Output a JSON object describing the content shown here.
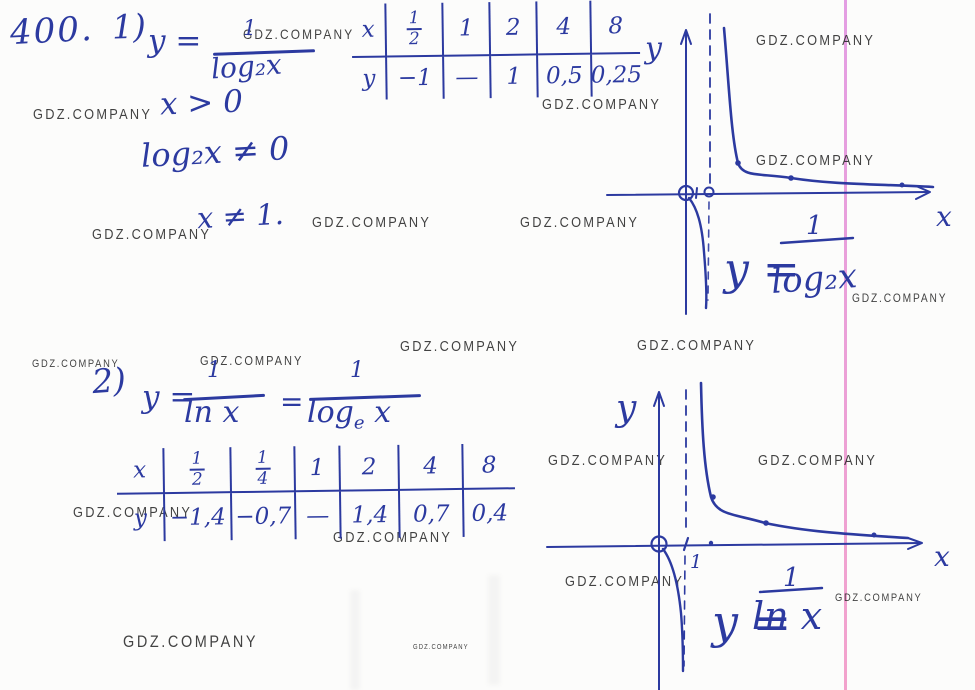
{
  "colors": {
    "ink": "#2c3aa0",
    "watermark": "#222222",
    "paper": "#fcfcfb",
    "margin_line_top": "#dd86dd",
    "margin_line_bottom": "#f08cc0"
  },
  "watermark": {
    "text": "GDZ.COMPANY",
    "positions": [
      {
        "x": 243,
        "y": 26,
        "size": 14
      },
      {
        "x": 542,
        "y": 96,
        "size": 15
      },
      {
        "x": 756,
        "y": 32,
        "size": 15
      },
      {
        "x": 756,
        "y": 152,
        "size": 15
      },
      {
        "x": 33,
        "y": 106,
        "size": 15
      },
      {
        "x": 92,
        "y": 226,
        "size": 15
      },
      {
        "x": 312,
        "y": 214,
        "size": 15
      },
      {
        "x": 520,
        "y": 214,
        "size": 15
      },
      {
        "x": 852,
        "y": 291,
        "size": 12
      },
      {
        "x": 32,
        "y": 358,
        "size": 11
      },
      {
        "x": 200,
        "y": 353,
        "size": 13
      },
      {
        "x": 400,
        "y": 338,
        "size": 15
      },
      {
        "x": 637,
        "y": 337,
        "size": 15
      },
      {
        "x": 73,
        "y": 504,
        "size": 15
      },
      {
        "x": 333,
        "y": 529,
        "size": 15
      },
      {
        "x": 548,
        "y": 452,
        "size": 15
      },
      {
        "x": 758,
        "y": 452,
        "size": 15
      },
      {
        "x": 565,
        "y": 573,
        "size": 15
      },
      {
        "x": 835,
        "y": 592,
        "size": 11
      },
      {
        "x": 123,
        "y": 632,
        "size": 17
      },
      {
        "x": 413,
        "y": 644,
        "size": 7
      }
    ]
  },
  "part1": {
    "problem_number": "400.",
    "item": "1)",
    "lhs": "y =",
    "num": "1",
    "den": "log₂x",
    "cond1": "x > 0",
    "cond2": "log₂x ≠ 0",
    "cond3": "x ≠ 1."
  },
  "part2": {
    "item": "2)",
    "lhs": "y =",
    "num1": "1",
    "den1": "ln x",
    "eq2": "=",
    "num2": "1",
    "den2_fn": "log",
    "den2_sub": "e",
    "den2_arg": "x"
  },
  "graph1": {
    "y_label": "y",
    "x_label": "x",
    "formula_lhs": "y =",
    "formula_num": "1",
    "formula_den": "log₂x"
  },
  "graph2": {
    "y_label": "y",
    "x_label": "x",
    "tick_1": "1",
    "formula_lhs": "y =",
    "formula_num": "1",
    "formula_den": "ln x"
  },
  "tables": [
    {
      "row_x": [
        "x",
        "1/2",
        "1",
        "2",
        "4",
        "8"
      ],
      "row_y": [
        "y",
        "−1",
        "—",
        "1",
        "0,5",
        "0,25"
      ]
    },
    {
      "row_x": [
        "x",
        "1/2",
        "1/4",
        "1",
        "2",
        "4",
        "8"
      ],
      "row_y": [
        "y",
        "−1,4",
        "−0,7",
        "—",
        "1,4",
        "0,7",
        "0,4"
      ]
    }
  ],
  "chart_data": [
    {
      "type": "line",
      "title": "y = 1/log₂x",
      "xlabel": "x",
      "ylabel": "y",
      "asymptotes": {
        "vertical_x": 1,
        "horizontal_y": 0
      },
      "table": {
        "x": [
          "1/2",
          "1",
          "2",
          "4",
          "8"
        ],
        "y": [
          "-1",
          "—",
          "1",
          "0,5",
          "0,25"
        ]
      },
      "branches": [
        {
          "domain": "0<x<1",
          "points": [
            [
              0.5,
              -1
            ]
          ]
        },
        {
          "domain": "x>1",
          "points": [
            [
              2,
              1
            ],
            [
              4,
              0.5
            ],
            [
              8,
              0.25
            ]
          ]
        }
      ],
      "grid": false,
      "marked_axis_points": [
        0,
        1
      ]
    },
    {
      "type": "line",
      "title": "y = 1/ln x",
      "xlabel": "x",
      "ylabel": "y",
      "asymptotes": {
        "vertical_x": 1,
        "horizontal_y": 0
      },
      "table": {
        "x": [
          "1/2",
          "1/4",
          "1",
          "2",
          "4",
          "8"
        ],
        "y": [
          "-1,4",
          "-0,7",
          "—",
          "1,4",
          "0,7",
          "0,4"
        ]
      },
      "branches": [
        {
          "domain": "0<x<1",
          "points": [
            [
              0.5,
              -1.4
            ],
            [
              0.25,
              -0.7
            ]
          ]
        },
        {
          "domain": "x>1",
          "points": [
            [
              2,
              1.4
            ],
            [
              4,
              0.7
            ],
            [
              8,
              0.4
            ]
          ]
        }
      ],
      "grid": false,
      "marked_axis_points": [
        0,
        1
      ]
    }
  ]
}
